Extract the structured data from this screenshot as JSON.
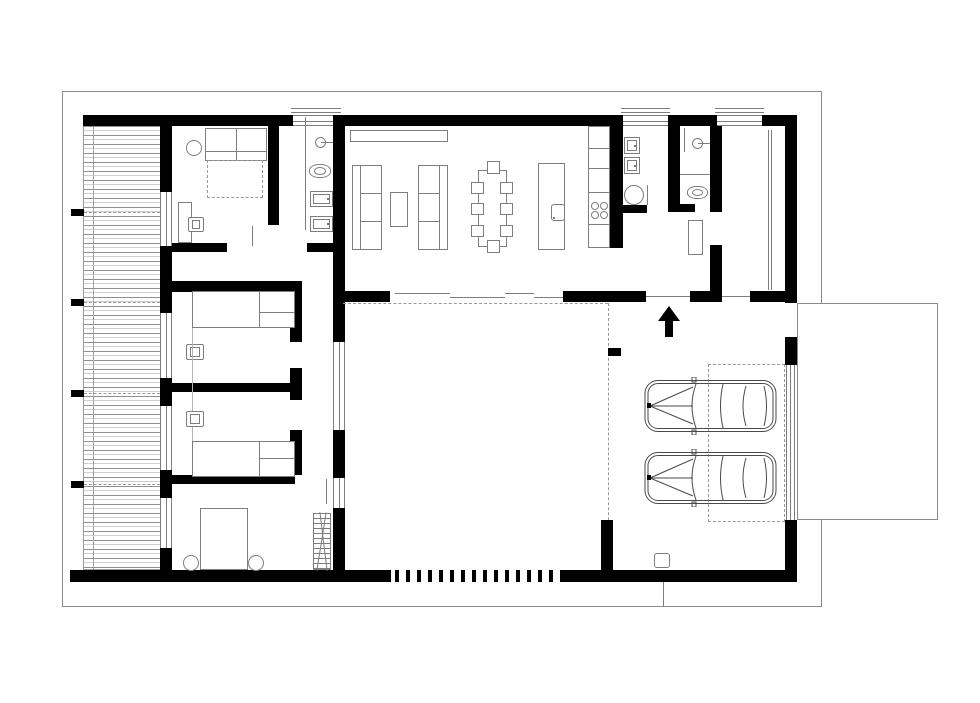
{
  "palette": {
    "bg": "#ffffff",
    "wall": "#000000",
    "line": "#8a8a8a",
    "furn": "#7d7d7d",
    "dash": "#9a9a9a"
  },
  "legend": {
    "walls": "solid-black-poche",
    "windows": "double-line-glazing",
    "roof_overhang": "dash-dot-line",
    "sliding_doors": "offset-thin-lines",
    "deck": "horizontal-board-hatch"
  },
  "symbols": [
    {
      "name": "double-bed",
      "count": 1
    },
    {
      "name": "single-bed",
      "count": 2
    },
    {
      "name": "bed-throw-dashed",
      "count": 1
    },
    {
      "name": "sofa",
      "count": 2
    },
    {
      "name": "coffee-table",
      "count": 1
    },
    {
      "name": "tv-console",
      "count": 1
    },
    {
      "name": "dining-table",
      "count": 1
    },
    {
      "name": "dining-chair",
      "count": 8
    },
    {
      "name": "kitchen-island-with-sink",
      "count": 1
    },
    {
      "name": "kitchen-counter",
      "count": 1
    },
    {
      "name": "cooktop-4-burner",
      "count": 1
    },
    {
      "name": "washer-dryer-unit",
      "count": 4
    },
    {
      "name": "round-appliance",
      "count": 1
    },
    {
      "name": "toilet",
      "count": 2
    },
    {
      "name": "washbasin-with-tap",
      "count": 2
    },
    {
      "name": "desk",
      "count": 1
    },
    {
      "name": "desk-chair",
      "count": 3
    },
    {
      "name": "round-stool",
      "count": 3
    },
    {
      "name": "wardrobe-rack",
      "count": 1
    },
    {
      "name": "storage-cabinet",
      "count": 1
    },
    {
      "name": "car-top-view",
      "count": 2
    },
    {
      "name": "entrance-arrow",
      "count": 1
    },
    {
      "name": "parking-bay-dashed",
      "count": 1
    },
    {
      "name": "wood-deck",
      "count": 1
    },
    {
      "name": "courtyard",
      "count": 1
    },
    {
      "name": "carport",
      "count": 1
    },
    {
      "name": "driveway",
      "count": 1
    },
    {
      "name": "louvre-fence",
      "count": 1
    },
    {
      "name": "floor-drain",
      "count": 1
    }
  ]
}
